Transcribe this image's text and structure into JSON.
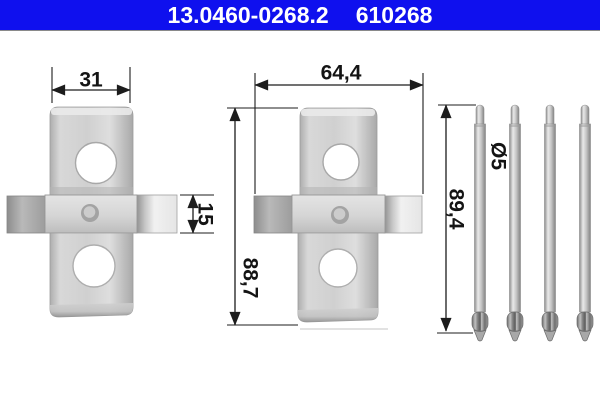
{
  "header": {
    "part_number": "13.0460-0268.2",
    "reference_number": "610268",
    "bar_color": "#0f10ee",
    "text_color": "#ffffff"
  },
  "drawing": {
    "pin_count": 4,
    "labels": {
      "clip_small_width": "31",
      "clip_small_tab_height": "15",
      "clip_large_width": "64,4",
      "clip_large_height": "88,7",
      "pin_length": "89,4",
      "pin_diameter": "Ø5"
    }
  }
}
